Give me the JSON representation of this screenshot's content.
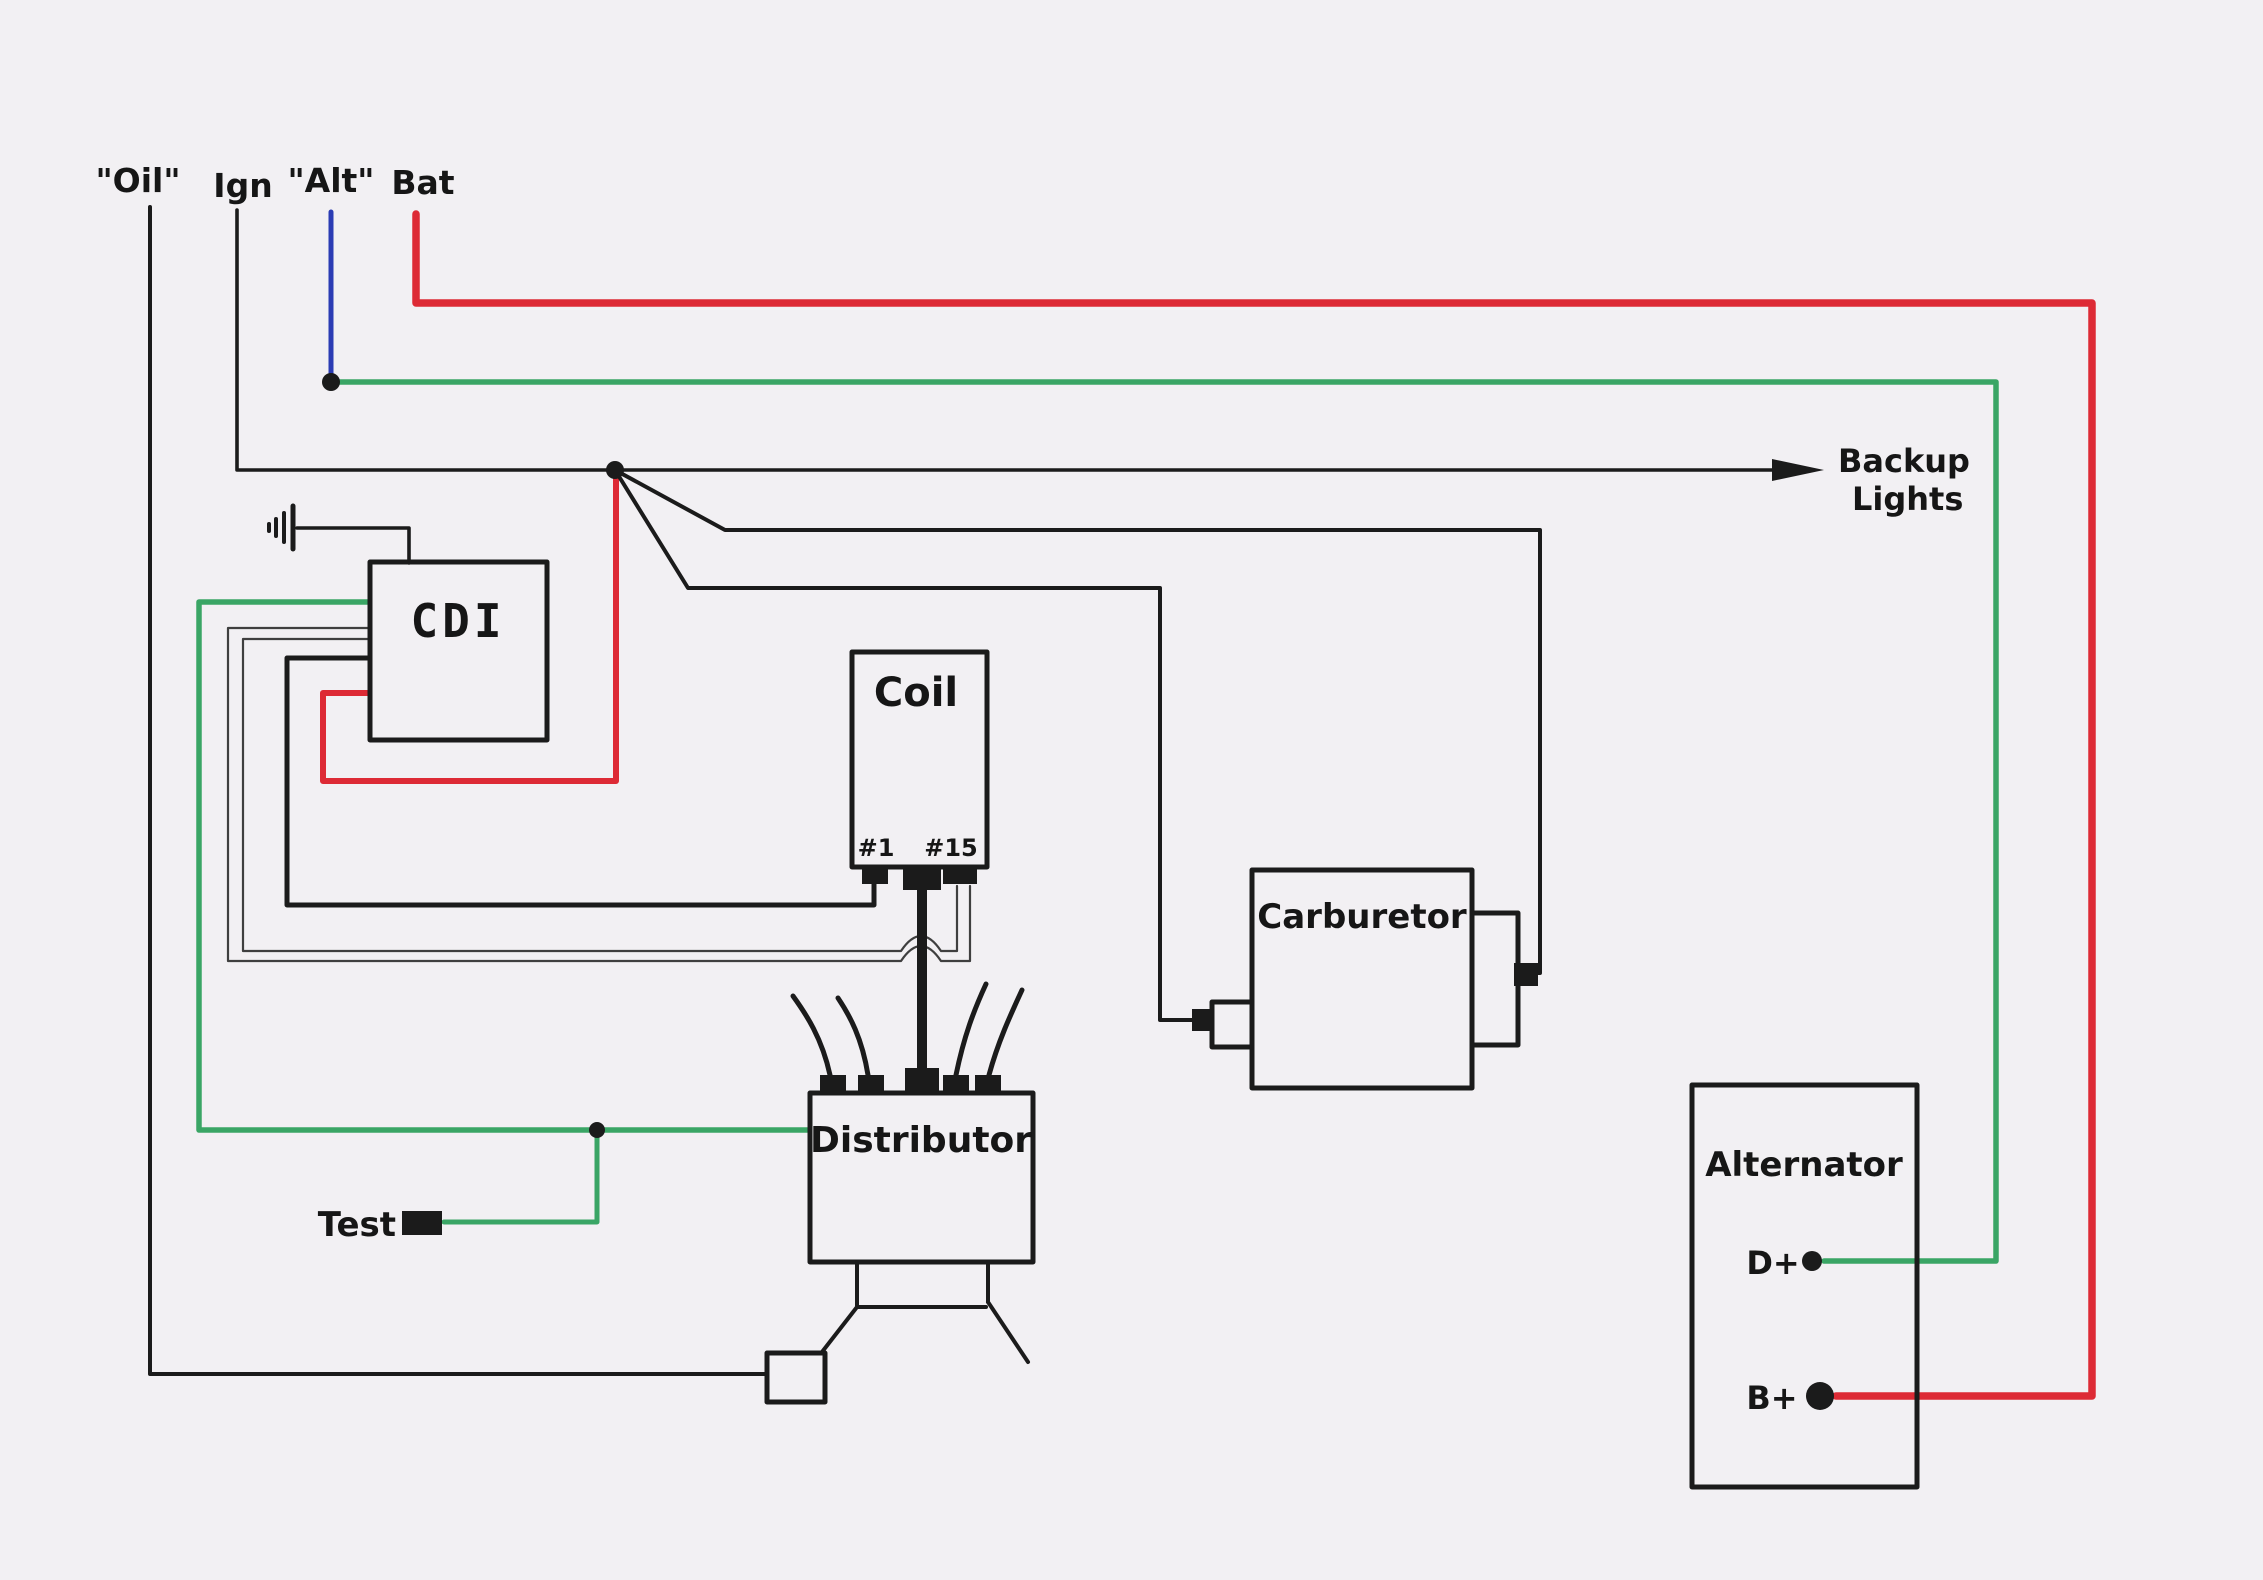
{
  "diagram": {
    "terminals": {
      "oil": "\"Oil\"",
      "ign": "Ign",
      "alt": "\"Alt\"",
      "bat": "Bat"
    },
    "components": {
      "cdi": "CDI",
      "coil": "Coil",
      "coil_terminal_1": "#1",
      "coil_terminal_15": "#15",
      "carburetor": "Carburetor",
      "distributor": "Distributor",
      "alternator": "Alternator",
      "alternator_d_plus": "D+",
      "alternator_b_plus": "B+"
    },
    "annotations": {
      "backup_lights_line1": "Backup",
      "backup_lights_line2": "Lights",
      "test": "Test"
    },
    "colors": {
      "paper": "#f2f0f3",
      "wire_black": "#1b1b1b",
      "wire_red": "#dd2a35",
      "wire_green": "#3aa565",
      "wire_blue": "#2b3cb4",
      "wire_gray": "#3f3f3f"
    }
  }
}
